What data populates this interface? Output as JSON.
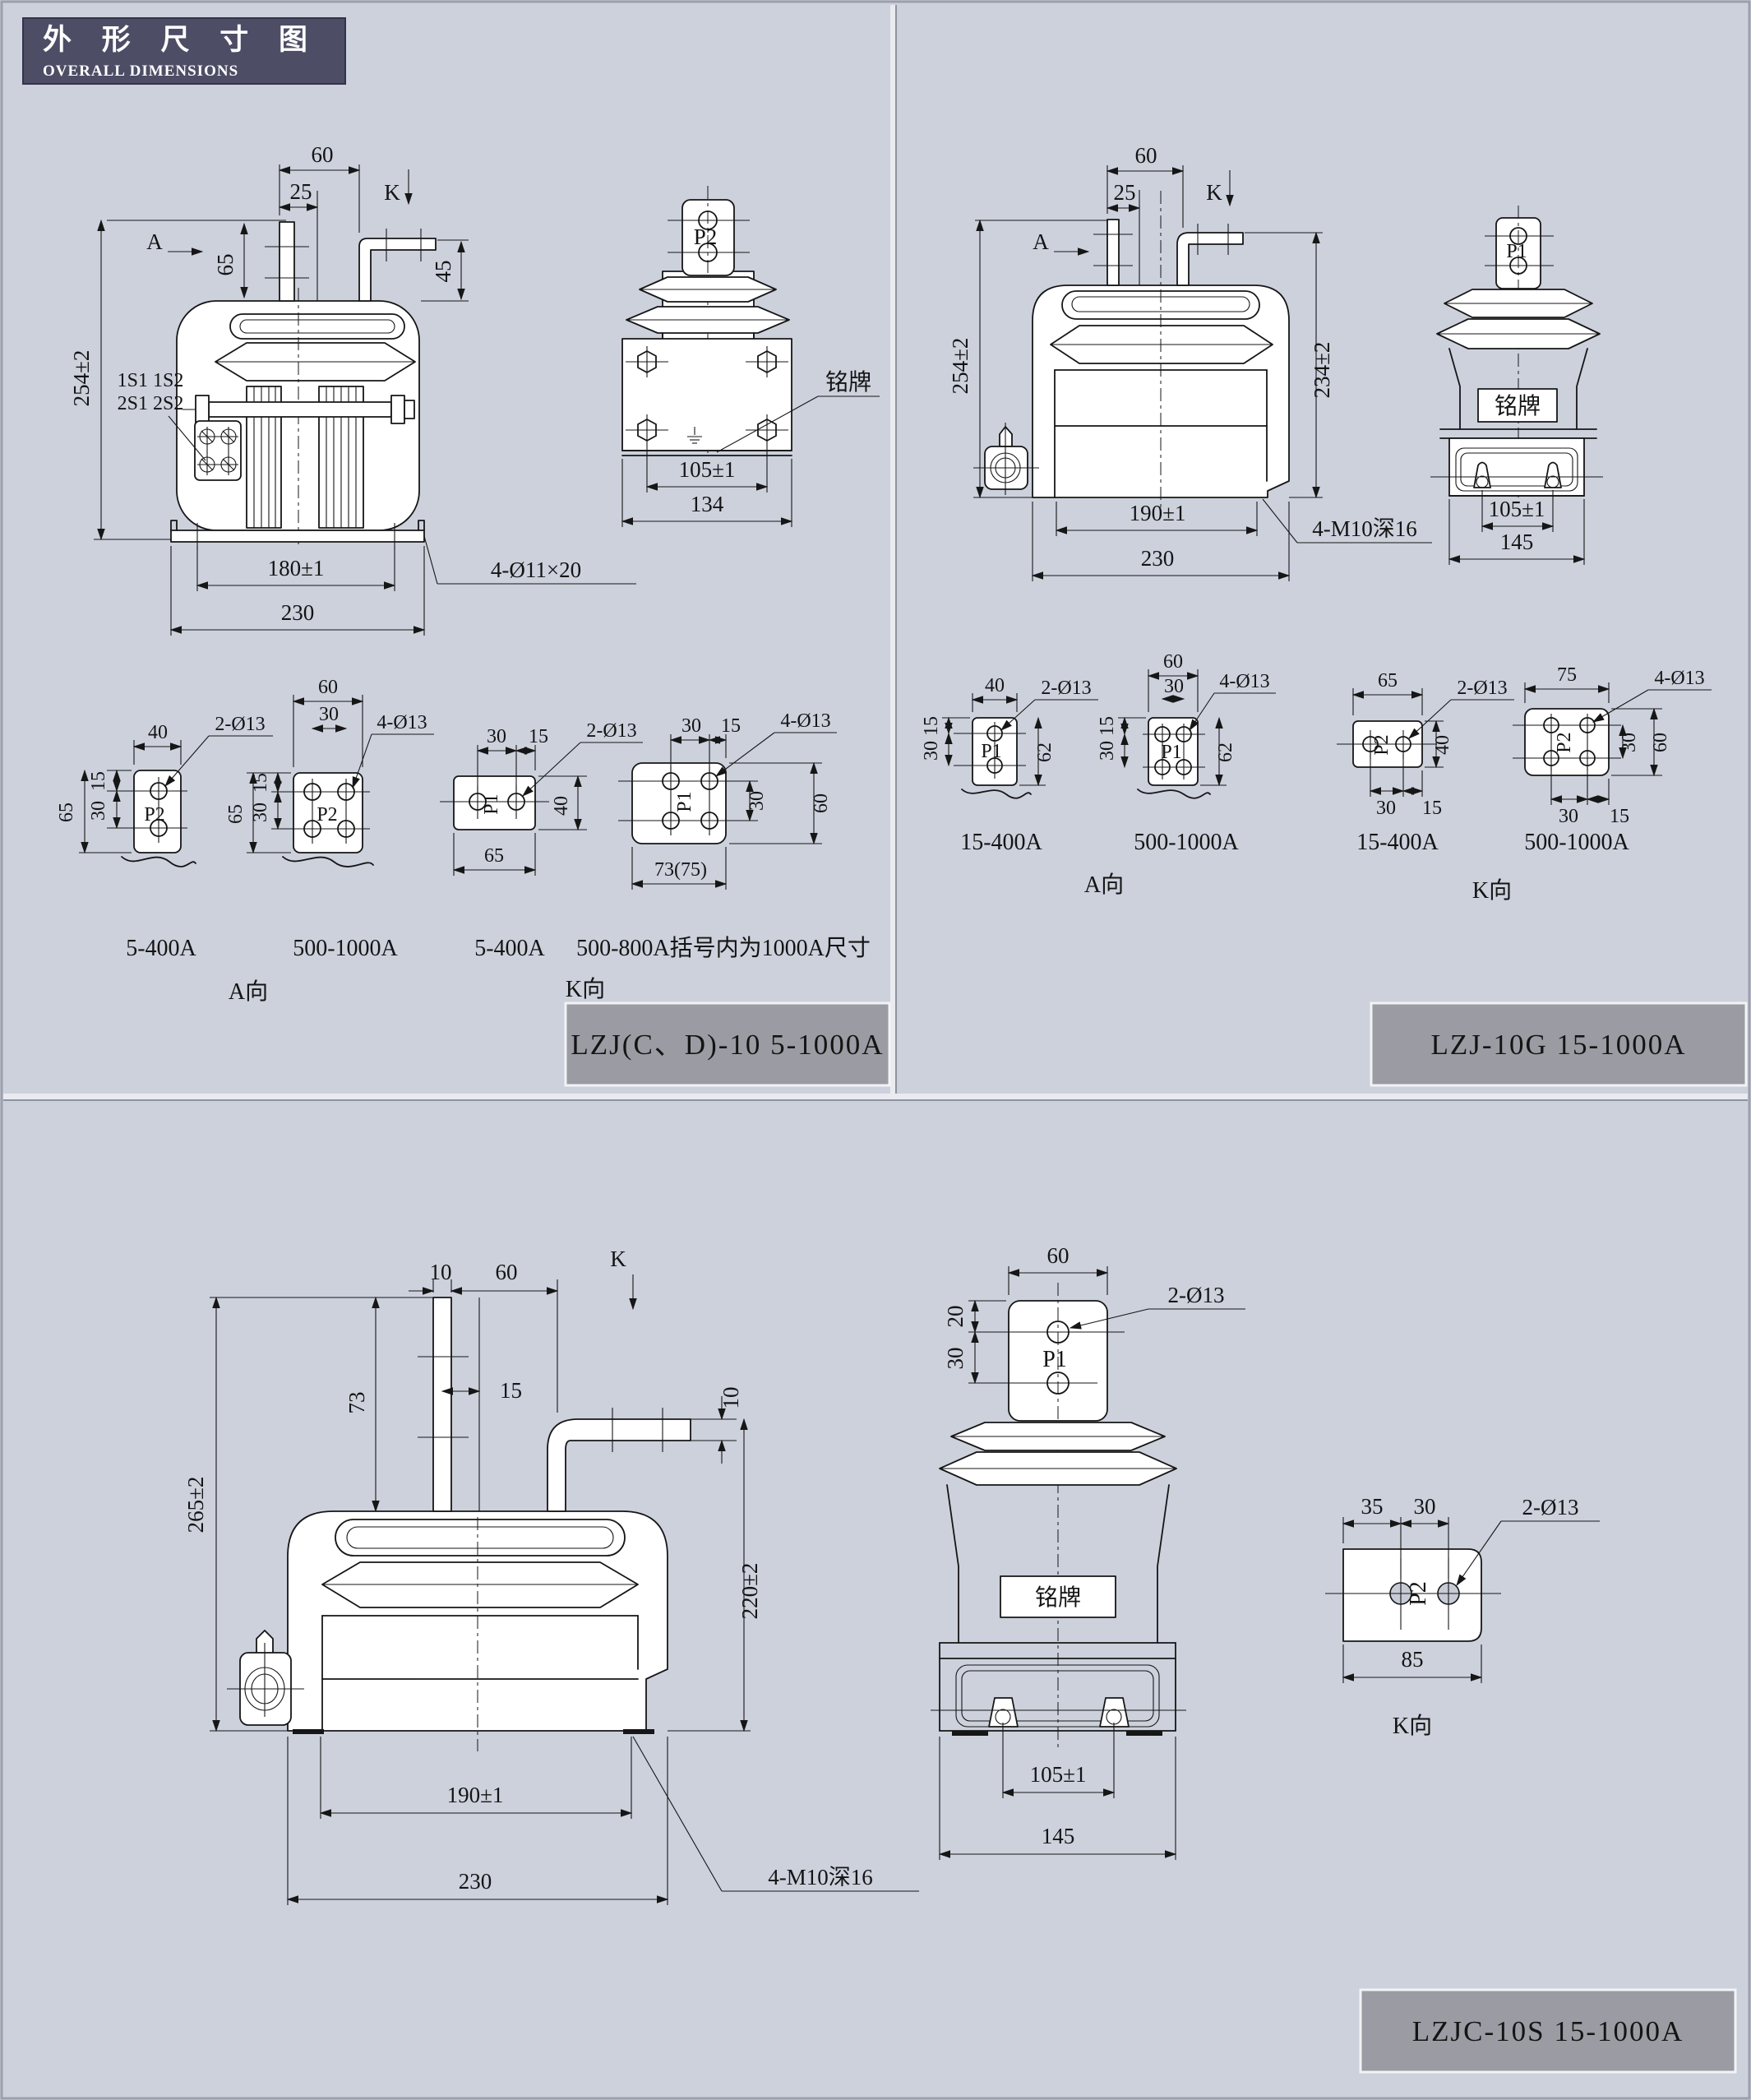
{
  "header": {
    "cn": "外 形 尺 寸 图",
    "en": "OVERALL DIMENSIONS"
  },
  "titles": {
    "left": "LZJ(C、D)-10  5-1000A",
    "right": "LZJ-10G  15-1000A",
    "bottom": "LZJC-10S  15-1000A"
  },
  "dims": {
    "n10": "10",
    "n15": "15",
    "n20": "20",
    "n25": "25",
    "n30": "30",
    "n35": "35",
    "n40": "40",
    "n45": "45",
    "n60": "60",
    "n62": "62",
    "n65": "65",
    "n73": "73",
    "n73_75": "73(75)",
    "n75": "75",
    "n85": "85",
    "n105": "105±1",
    "n134": "134",
    "n145": "145",
    "n180": "180±1",
    "n190": "190±1",
    "n220": "220±2",
    "n230": "230",
    "n234": "234±2",
    "n254": "254±2",
    "n265": "265±2"
  },
  "labels": {
    "holes2": "2-Ø13",
    "holes4": "4-Ø13",
    "holes11": "4-Ø11×20",
    "m10": "4-M10深16",
    "nameplate": "铭牌",
    "sTop": "1S1 1S2",
    "sBot": "2S1 2S2",
    "p1": "P1",
    "p2": "P2",
    "viewA": "A向",
    "viewK": "K向",
    "arrowA": "A",
    "arrowK": "K",
    "r5_400": "5-400A",
    "r500_1000": "500-1000A",
    "r15_400": "15-400A",
    "noteParen": "500-800A括号内为1000A尺寸"
  },
  "colors": {
    "background": "#ccd1dc",
    "headerBg": "#4d4d66",
    "titleBarBg": "#9b9ba3",
    "line": "#161616"
  }
}
